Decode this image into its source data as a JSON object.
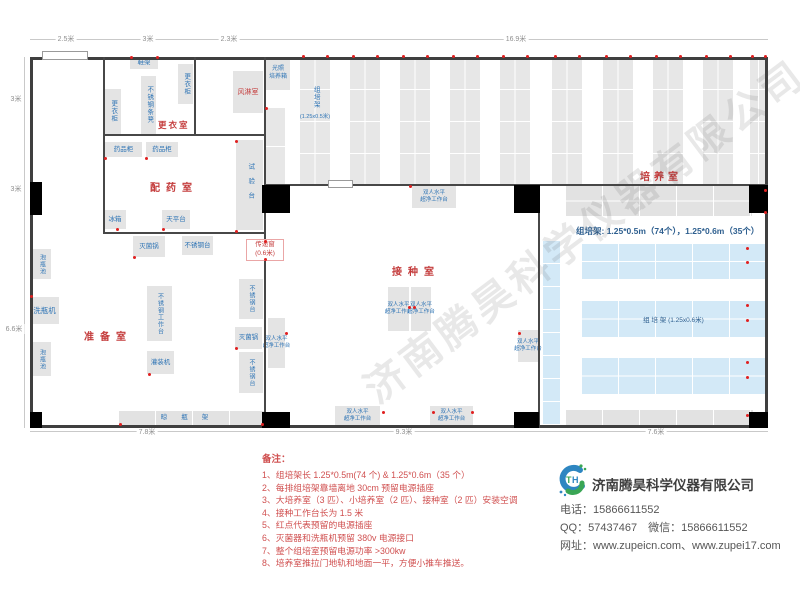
{
  "watermark": "济南腾昊科学仪器有限公司",
  "dims": {
    "top": [
      "2.5米",
      "3米",
      "2.3米",
      "16.9米"
    ],
    "left": [
      "3米",
      "3米",
      "6.6米"
    ],
    "bottom": [
      "7.8米",
      "9.3米",
      "7.6米"
    ]
  },
  "rooms": {
    "changing": "更衣室",
    "air_shower": "风淋室",
    "dispensing": "配药室",
    "prep": "准备室",
    "inoculation": "接种室",
    "culture": "培养室"
  },
  "equipment": {
    "shoe_rack": "鞋架",
    "locker": "更衣柜",
    "steel_bench": "不锈钢条凳",
    "medicine_cabinet": "药品柜",
    "test_bench": "试验台",
    "fridge": "冰箱",
    "balance_table": "天平台",
    "sterilizer": "灭菌锅",
    "steel_table": "不锈钢台",
    "soak_pool": "泡瓶池",
    "bottle_washer": "洗瓶机",
    "steel_worktable": "不锈钢工作台",
    "filling_machine": "灌装机",
    "drying_rack": "晾瓶架",
    "clean_bench_line1": "双人水平",
    "clean_bench_line2": "超净工作台",
    "light_incubator_line1": "光照",
    "light_incubator_line2": "培养箱",
    "pass_window": "传递窗",
    "pass_window_size": "(0.6米)",
    "rack_name": "组培架",
    "rack_small_spec": "(1.25x0.5米)",
    "rack_large_label": "组 培 架 (1.25x0.6米)",
    "rack_summary": "组培架: 1.25*0.5m（74个），1.25*0.6m（35个）"
  },
  "notes": {
    "heading": "备注：",
    "items": [
      "1、组培架长 1.25*0.5m(74 个) & 1.25*0.6m（35 个）",
      "2、每排组培架靠墙离地 30cm 预留电源插座",
      "3、大培养室（3 匹）、小培养室（2 匹）、接种室（2 匹）安装空调",
      "4、接种工作台长为 1.5 米",
      "5、红点代表预留的电源插座",
      "6、灭菌器和洗瓶机预留 380v 电源接口",
      "7、整个组培室预留电源功率 >300kw",
      "8、培养室推拉门地轨和地面一平，方便小推车推送。"
    ]
  },
  "company": {
    "name": "济南腾昊科学仪器有限公司",
    "phone_label": "电话：",
    "phone": "15866611552",
    "qq_label": "QQ：",
    "qq": "57437467",
    "wechat_label": "微信：",
    "wechat": "15866611552",
    "web_label": "网址：",
    "websites": "www.zupeicn.com、www.zupei17.com"
  },
  "colors": {
    "accent_red": "#c43c3c",
    "label_blue": "#2e74b5",
    "rack_blue": "#d3e9f7",
    "equipment_grey": "#e4e4e4",
    "wall": "#474747",
    "outlet_red": "#e02020"
  }
}
